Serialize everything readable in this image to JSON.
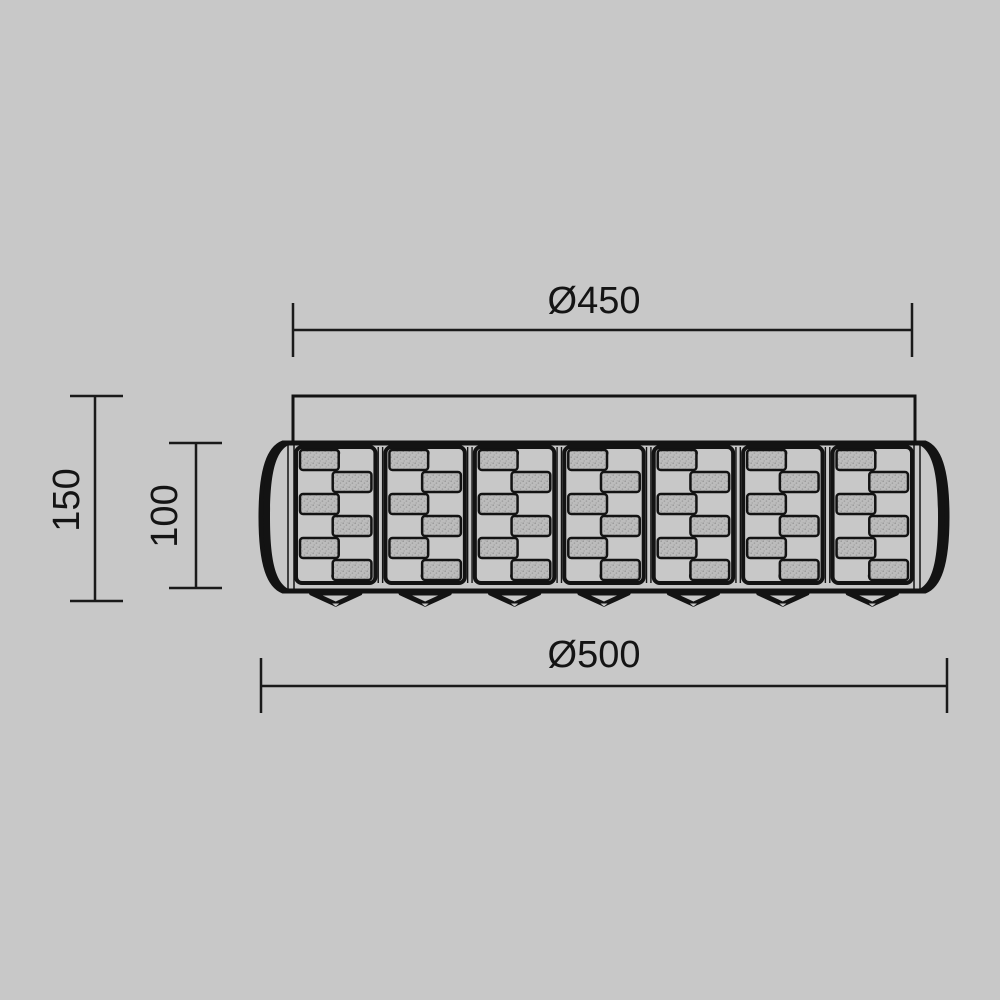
{
  "document": {
    "title": "Ceiling lamp technical dimension drawing",
    "background_color": "#c8c8c8",
    "line_color": "#131313",
    "stipple_fill_color": "#bcbcbc",
    "stipple_dot_color": "#969696"
  },
  "dimensions": {
    "top_width": {
      "label": "Ø450"
    },
    "bottom_width": {
      "label": "Ø500"
    },
    "overall_height": {
      "label": "150"
    },
    "body_height": {
      "label": "100"
    }
  },
  "lamp": {
    "panel_count": 7,
    "rows_per_panel": 6,
    "finial_count": 7
  }
}
